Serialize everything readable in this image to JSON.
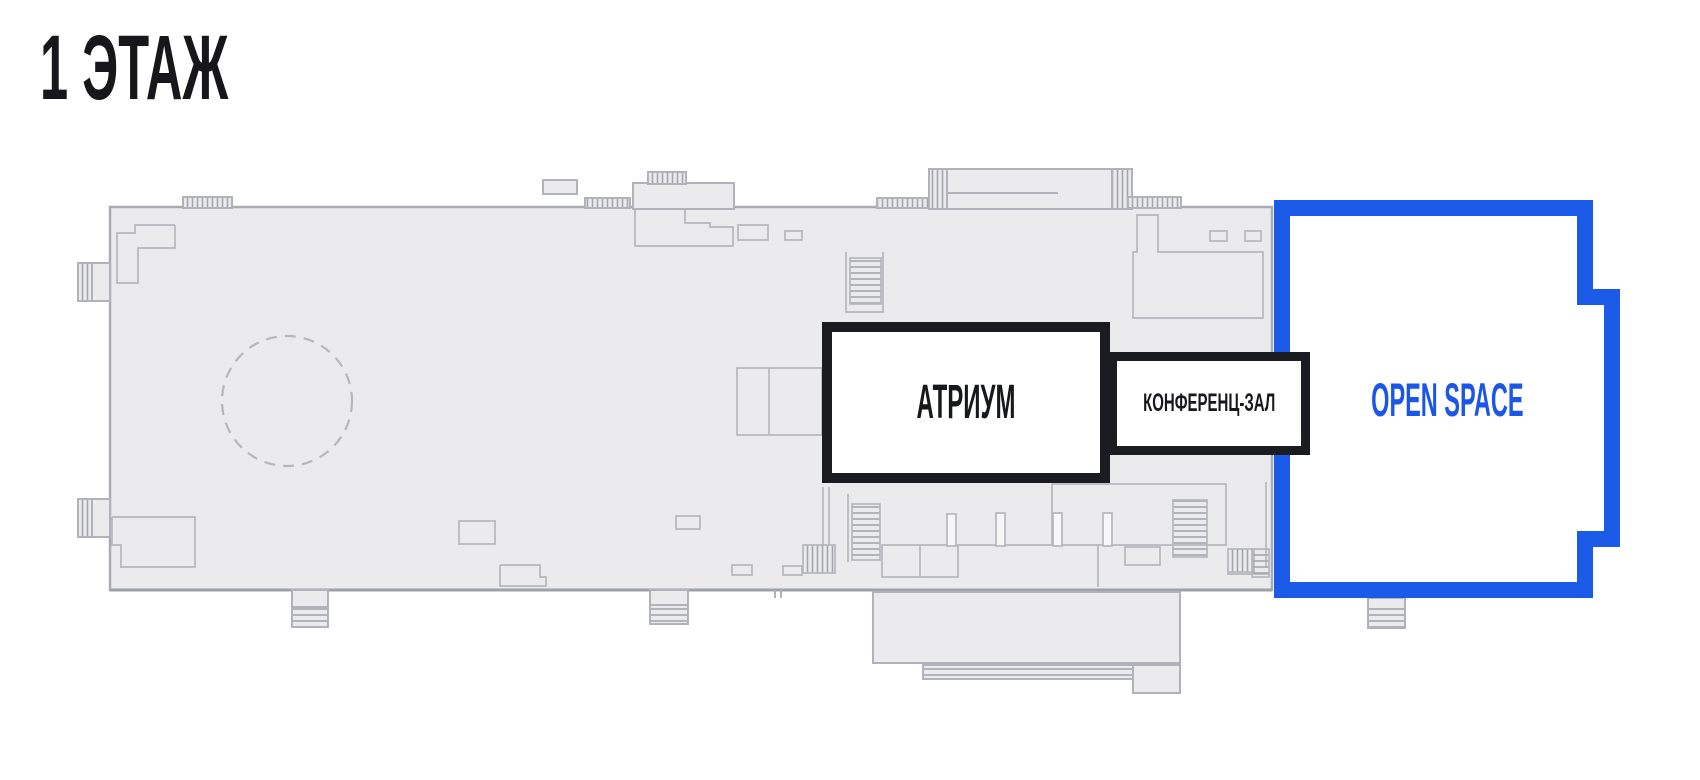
{
  "page": {
    "title": "1 ЭТАЖ",
    "background_color": "#ffffff"
  },
  "floor_plan": {
    "building_fill": "#ebebed",
    "building_outline_color": "#a9abb2",
    "interior_line_color": "#b6b7be",
    "accent_color": "#1c5ae8",
    "rooms": [
      {
        "id": "atrium",
        "label": "АТРИУМ",
        "border_color": "#1b1c22",
        "text_color": "#17181c",
        "highlighted": false
      },
      {
        "id": "conference-hall",
        "label": "КОНФЕРЕНЦ-ЗАЛ",
        "border_color": "#1b1c22",
        "text_color": "#17181c",
        "highlighted": false
      },
      {
        "id": "open-space",
        "label": "OPEN SPACE",
        "border_color": "#1c5ae8",
        "text_color": "#1c56e6",
        "highlighted": true
      }
    ]
  }
}
